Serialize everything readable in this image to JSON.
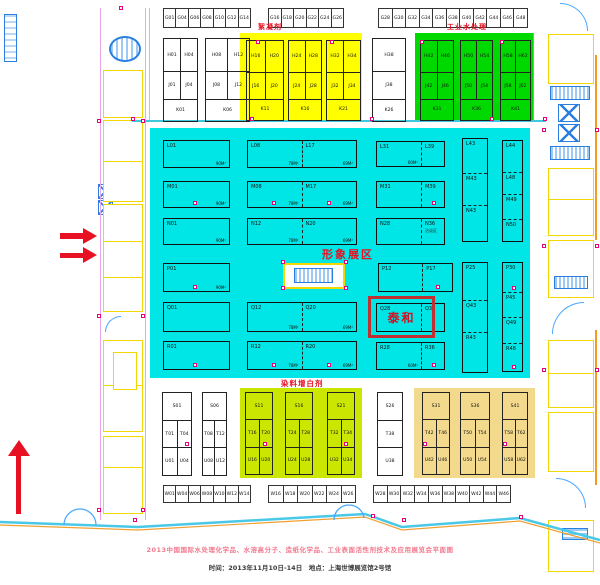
{
  "titles": {
    "flocculant": "絮凝剂",
    "industrial_water": "工业水处理",
    "image_zone": "形象展区",
    "dye_whitening": "染料增白剂",
    "taihe": "泰和"
  },
  "footer": {
    "line1": "2013中国国际水处理化学品、水溶高分子、造纸化学品、工业表面活性剂技术及应用展览会平面图",
    "line2": "时间：2013年11月10日-14日　地点：上海世博展览馆2号馆"
  },
  "colors": {
    "cyan_region": "#00e5e5",
    "yellow_region": "#ffff00",
    "green_region": "#00d900",
    "dye_region": "#cbe600",
    "orange_region": "#f3d98c",
    "accent_red": "#e81123",
    "magenta_marker": "#e6007e",
    "cad_yellow": "#f0d800",
    "cad_blue": "#2b7fe0"
  },
  "g_row": [
    [
      "G01",
      "G04",
      "G06",
      "G08",
      "G10",
      "G12",
      "G14"
    ],
    [
      "G16",
      "G18",
      "G20",
      "G22",
      "G24",
      "G26"
    ],
    [
      "G28",
      "G30",
      "G32",
      "G34",
      "G36",
      "G38",
      "G40",
      "G42",
      "G44",
      "G46",
      "G48"
    ]
  ],
  "w_row": [
    [
      "W01",
      "W04",
      "W06",
      "W08",
      "W10",
      "W12",
      "W14"
    ],
    [
      "W16",
      "W18",
      "W20",
      "W22",
      "W24",
      "W26"
    ],
    [
      "W28",
      "W30",
      "W32",
      "W34",
      "W36",
      "W38",
      "W40",
      "W42",
      "W44",
      "W46"
    ]
  ],
  "top_blocks": [
    {
      "x": 163,
      "y": 38,
      "w": 35,
      "h": 84,
      "rows": [
        [
          "H01",
          "H04"
        ],
        [
          "J01",
          "J04"
        ],
        [
          "K01"
        ]
      ]
    },
    {
      "x": 205,
      "y": 38,
      "w": 45,
      "h": 84,
      "rows": [
        [
          "H08",
          "H12"
        ],
        [
          "J08",
          "J12"
        ],
        [
          "K06"
        ]
      ]
    },
    {
      "x": 246,
      "y": 40,
      "w": 38,
      "h": 81,
      "rows": [
        [
          "H16",
          "H20"
        ],
        [
          "J16",
          "J20"
        ],
        [
          "K11"
        ]
      ]
    },
    {
      "x": 288,
      "y": 40,
      "w": 34,
      "h": 81,
      "rows": [
        [
          "H24",
          "H28"
        ],
        [
          "J24",
          "J28"
        ],
        [
          "K16"
        ]
      ]
    },
    {
      "x": 326,
      "y": 40,
      "w": 35,
      "h": 81,
      "rows": [
        [
          "H32",
          "H34"
        ],
        [
          "J32",
          "J34"
        ],
        [
          "K21"
        ]
      ]
    },
    {
      "x": 372,
      "y": 38,
      "w": 34,
      "h": 84,
      "rows": [
        [
          "H38"
        ],
        [
          "J38"
        ],
        [
          "K26"
        ]
      ]
    },
    {
      "x": 420,
      "y": 40,
      "w": 34,
      "h": 81,
      "rows": [
        [
          "H42",
          "H46"
        ],
        [
          "J42",
          "J46"
        ],
        [
          "K31"
        ]
      ]
    },
    {
      "x": 460,
      "y": 40,
      "w": 33,
      "h": 81,
      "rows": [
        [
          "H50",
          "H54"
        ],
        [
          "J50",
          "J54"
        ],
        [
          "K36"
        ]
      ]
    },
    {
      "x": 500,
      "y": 40,
      "w": 31,
      "h": 81,
      "rows": [
        [
          "H58",
          "H62"
        ],
        [
          "J58",
          "J62"
        ],
        [
          "K41"
        ]
      ]
    }
  ],
  "bottom_blocks": [
    {
      "x": 162,
      "y": 392,
      "w": 30,
      "h": 84,
      "rows": [
        [
          "S01"
        ],
        [
          "T01",
          "T04"
        ],
        [
          "U01",
          "U04"
        ]
      ]
    },
    {
      "x": 202,
      "y": 392,
      "w": 25,
      "h": 84,
      "rows": [
        [
          "S06"
        ],
        [
          "T08",
          "T12"
        ],
        [
          "U08",
          "U12"
        ]
      ]
    },
    {
      "x": 245,
      "y": 392,
      "w": 28,
      "h": 83,
      "rows": [
        [
          "S11"
        ],
        [
          "T16",
          "T20"
        ],
        [
          "U16",
          "U20"
        ]
      ]
    },
    {
      "x": 285,
      "y": 392,
      "w": 28,
      "h": 83,
      "rows": [
        [
          "S16"
        ],
        [
          "T24",
          "T28"
        ],
        [
          "U24",
          "U28"
        ]
      ]
    },
    {
      "x": 327,
      "y": 392,
      "w": 28,
      "h": 83,
      "rows": [
        [
          "S21"
        ],
        [
          "T32",
          "T34"
        ],
        [
          "U32",
          "U34"
        ]
      ]
    },
    {
      "x": 377,
      "y": 392,
      "w": 26,
      "h": 84,
      "rows": [
        [
          "S26"
        ],
        [
          "T38"
        ],
        [
          "U38"
        ]
      ]
    },
    {
      "x": 422,
      "y": 392,
      "w": 28,
      "h": 83,
      "rows": [
        [
          "S31"
        ],
        [
          "T42",
          "T46"
        ],
        [
          "U42",
          "U46"
        ]
      ]
    },
    {
      "x": 460,
      "y": 392,
      "w": 30,
      "h": 83,
      "rows": [
        [
          "S36"
        ],
        [
          "T50",
          "T54"
        ],
        [
          "U50",
          "U54"
        ]
      ]
    },
    {
      "x": 502,
      "y": 392,
      "w": 26,
      "h": 83,
      "rows": [
        [
          "S41"
        ],
        [
          "T58",
          "T62"
        ],
        [
          "U58",
          "U62"
        ]
      ]
    }
  ],
  "center_blocks": [
    {
      "x": 13,
      "y": 12,
      "w": 67,
      "h": 28,
      "cells": [
        {
          "id": "L01",
          "area": "90M²"
        }
      ]
    },
    {
      "x": 97,
      "y": 12,
      "w": 110,
      "h": 28,
      "cells": [
        {
          "id": "L08",
          "area": "78M²"
        },
        {
          "id": "L17",
          "area": "69M²"
        }
      ]
    },
    {
      "x": 226,
      "y": 13,
      "w": 69,
      "h": 26,
      "cells": [
        {
          "id": "L31",
          "area": "60M²",
          "fr": 2
        },
        {
          "id": "L39",
          "fr": 1
        }
      ]
    },
    {
      "x": 312,
      "y": 10,
      "w": 26,
      "h": 104,
      "vertical": true,
      "cells": [
        {
          "id": "L43",
          "fr": 35
        },
        {
          "id": "M43",
          "fr": 33
        },
        {
          "id": "N43",
          "fr": 36
        }
      ]
    },
    {
      "x": 352,
      "y": 12,
      "w": 21,
      "h": 102,
      "vertical": true,
      "cells": [
        {
          "id": "L44",
          "fr": 33
        },
        {
          "id": "L48",
          "fr": 22
        },
        {
          "id": "M49",
          "fr": 25
        },
        {
          "id": "N50",
          "fr": 22
        }
      ]
    },
    {
      "x": 13,
      "y": 53,
      "w": 67,
      "h": 27,
      "cells": [
        {
          "id": "M01",
          "area": "90M²",
          "dot": true
        }
      ]
    },
    {
      "x": 97,
      "y": 53,
      "w": 110,
      "h": 27,
      "cells": [
        {
          "id": "M08",
          "area": "78M²",
          "dot": true
        },
        {
          "id": "M17",
          "area": "69M²",
          "dot": true
        }
      ]
    },
    {
      "x": 226,
      "y": 53,
      "w": 69,
      "h": 27,
      "cells": [
        {
          "id": "M31",
          "fr": 2
        },
        {
          "id": "M39",
          "fr": 1,
          "dot": true
        }
      ]
    },
    {
      "x": 13,
      "y": 90,
      "w": 67,
      "h": 27,
      "cells": [
        {
          "id": "N01",
          "area": "90M²"
        }
      ]
    },
    {
      "x": 97,
      "y": 90,
      "w": 110,
      "h": 27,
      "cells": [
        {
          "id": "N12",
          "area": "78M²"
        },
        {
          "id": "N20",
          "area": "69M²"
        }
      ]
    },
    {
      "x": 226,
      "y": 90,
      "w": 69,
      "h": 27,
      "cells": [
        {
          "id": "N28",
          "fr": 2
        },
        {
          "id": "N36",
          "fr": 1,
          "note": "洽谈区"
        }
      ]
    },
    {
      "x": 13,
      "y": 135,
      "w": 67,
      "h": 29,
      "cells": [
        {
          "id": "P01",
          "area": "90M²",
          "dot": true
        }
      ]
    },
    {
      "x": 228,
      "y": 135,
      "w": 75,
      "h": 29,
      "cells": [
        {
          "id": "P12",
          "fr": 3
        },
        {
          "id": "P17",
          "fr": 2,
          "dot": true
        }
      ]
    },
    {
      "x": 312,
      "y": 134,
      "w": 26,
      "h": 111,
      "vertical": true,
      "cells": [
        {
          "id": "P25",
          "fr": 38
        },
        {
          "id": "Q43",
          "fr": 33
        },
        {
          "id": "R43",
          "fr": 40
        }
      ]
    },
    {
      "x": 352,
      "y": 134,
      "w": 21,
      "h": 110,
      "vertical": true,
      "cells": [
        {
          "id": "P30",
          "fr": 30,
          "dot": true
        },
        {
          "id": "P45",
          "fr": 25
        },
        {
          "id": "Q49",
          "fr": 27
        },
        {
          "id": "R48",
          "fr": 28,
          "dot": true
        }
      ]
    },
    {
      "x": 13,
      "y": 174,
      "w": 67,
      "h": 30,
      "cells": [
        {
          "id": "Q01"
        }
      ]
    },
    {
      "x": 97,
      "y": 174,
      "w": 110,
      "h": 30,
      "cells": [
        {
          "id": "Q12",
          "area": "78M²"
        },
        {
          "id": "Q20",
          "area": "69M²"
        }
      ]
    },
    {
      "x": 226,
      "y": 175,
      "w": 69,
      "h": 29,
      "cells": [
        {
          "id": "Q28",
          "fr": 2
        },
        {
          "id": "Q36",
          "fr": 1
        }
      ]
    },
    {
      "x": 13,
      "y": 213,
      "w": 67,
      "h": 29,
      "cells": [
        {
          "id": "R01",
          "dot": true
        }
      ]
    },
    {
      "x": 97,
      "y": 213,
      "w": 110,
      "h": 29,
      "cells": [
        {
          "id": "R12",
          "area": "78M²",
          "dot": true
        },
        {
          "id": "R20",
          "area": "69M²",
          "dot": true
        }
      ]
    },
    {
      "x": 226,
      "y": 214,
      "w": 69,
      "h": 28,
      "cells": [
        {
          "id": "R28",
          "area": "60M²",
          "fr": 2
        },
        {
          "id": "R36",
          "fr": 1,
          "dot": true
        }
      ]
    }
  ]
}
